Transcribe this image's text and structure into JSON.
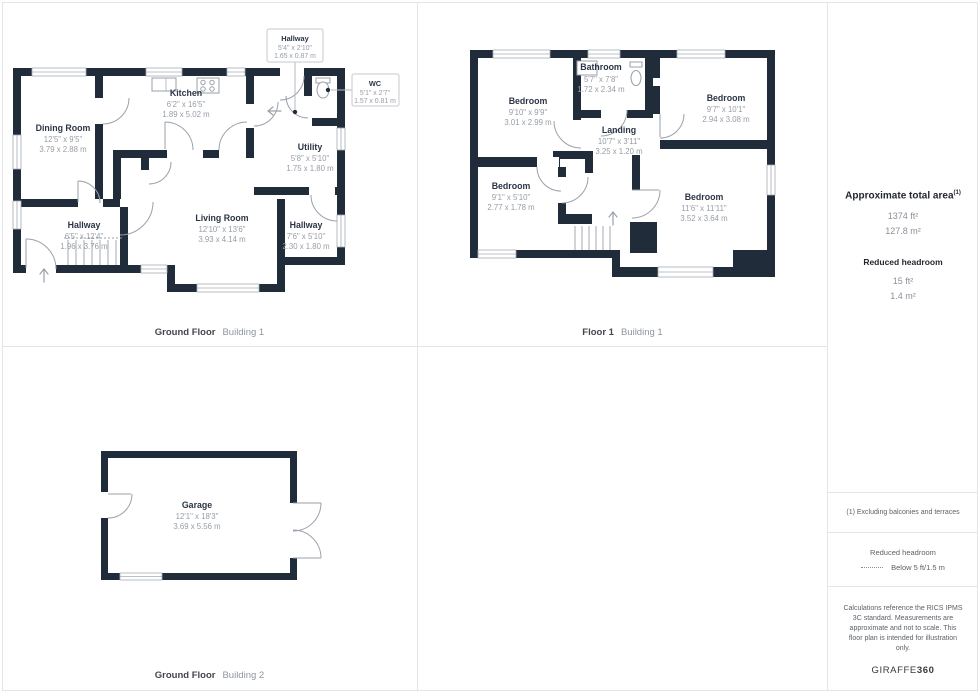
{
  "colors": {
    "wall": "#212c3b",
    "room_name": "#2b3545",
    "dims": "#979da6",
    "grid_line": "#e4e5e8",
    "caption_bold": "#42464d",
    "caption_light": "#8f959d"
  },
  "plans": {
    "gf1": {
      "caption_bold": "Ground Floor",
      "caption_light": "Building 1",
      "rooms": {
        "dining": {
          "name": "Dining Room",
          "ft": "12'5\" x 9'5\"",
          "m": "3.79 x 2.88 m"
        },
        "kitchen": {
          "name": "Kitchen",
          "ft": "6'2\" x 16'5\"",
          "m": "1.89 x 5.02 m"
        },
        "utility": {
          "name": "Utility",
          "ft": "5'8\" x 5'10\"",
          "m": "1.75 x 1.80 m"
        },
        "hallway": {
          "name": "Hallway",
          "ft": "6'5\" x 12'4\"",
          "m": "1.96 x 3.76 m"
        },
        "living": {
          "name": "Living Room",
          "ft": "12'10\" x 13'6\"",
          "m": "3.93 x 4.14 m"
        },
        "hallway2": {
          "name": "Hallway",
          "ft": "7'6\" x 5'10\"",
          "m": "2.30 x 1.80 m"
        }
      },
      "callouts": {
        "hallway": {
          "name": "Hallway",
          "ft": "5'4\" x 2'10\"",
          "m": "1.65 x 0.87 m"
        },
        "wc": {
          "name": "WC",
          "ft": "5'1\" x 2'7\"",
          "m": "1.57 x 0.81 m"
        }
      }
    },
    "f1": {
      "caption_bold": "Floor 1",
      "caption_light": "Building 1",
      "rooms": {
        "bed_tl": {
          "name": "Bedroom",
          "ft": "9'10\" x 9'9\"",
          "m": "3.01 x 2.99 m"
        },
        "bathroom": {
          "name": "Bathroom",
          "ft": "5'7\" x 7'8\"",
          "m": "1.72 x 2.34 m"
        },
        "bed_tr": {
          "name": "Bedroom",
          "ft": "9'7\" x 10'1\"",
          "m": "2.94 x 3.08 m"
        },
        "landing": {
          "name": "Landing",
          "ft": "10'7\" x 3'11\"",
          "m": "3.25 x 1.20 m"
        },
        "bed_l": {
          "name": "Bedroom",
          "ft": "9'1\" x 5'10\"",
          "m": "2.77 x 1.78 m"
        },
        "bed_br": {
          "name": "Bedroom",
          "ft": "11'6\" x 11'11\"",
          "m": "3.52 x 3.64 m"
        }
      }
    },
    "gf2": {
      "caption_bold": "Ground Floor",
      "caption_light": "Building 2",
      "rooms": {
        "garage": {
          "name": "Garage",
          "ft": "12'1\" x 18'3\"",
          "m": "3.69 x 5.56 m"
        }
      }
    }
  },
  "sidebar": {
    "area_title": "Approximate total area",
    "area_sup": "(1)",
    "area_ft": "1374 ft²",
    "area_m": "127.8 m²",
    "headroom_title": "Reduced headroom",
    "headroom_ft": "15 ft²",
    "headroom_m": "1.4 m²",
    "note1": "(1) Excluding balconies and terraces",
    "legend_title": "Reduced headroom",
    "legend_value": "Below 5 ft/1.5 m",
    "disclaimer": "Calculations reference the RICS IPMS 3C standard. Measurements are approximate and not to scale. This floor plan is intended for illustration only.",
    "logo_normal": "GIRAFFE",
    "logo_bold": "360"
  }
}
